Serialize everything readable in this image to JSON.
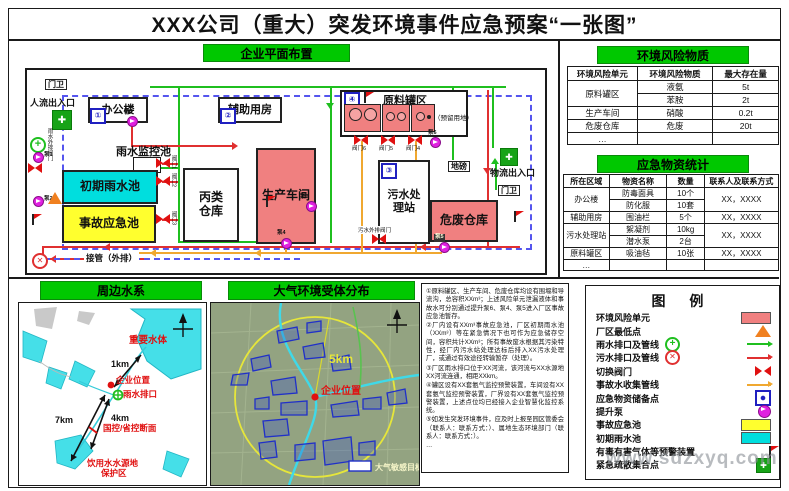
{
  "title": "XXX公司（重大）突发环境事件应急预案“一张图”",
  "watermark": "www.sdzxyq.com",
  "colors": {
    "header_green": "#00c800",
    "risk_unit_salmon": "#f08080",
    "initial_rain_cyan": "#00dede",
    "accident_pool_yellow": "#ffff2e",
    "rain_line_green": "#1fbf1f",
    "sewage_line_red": "#e03030",
    "accident_line_orange": "#f0a830",
    "pump_magenta": "#e020e0",
    "boundary_dash_blue": "#5555ee"
  },
  "plant": {
    "header": "企业平面布置",
    "gate1": "门卫",
    "gate2": "门卫",
    "people_entrance": "人流出入口",
    "logistics_entrance": "物流出入口",
    "office": "办公楼",
    "office_badge": "①",
    "aux_building": "辅助用房",
    "aux_badge": "②",
    "rain_monitor_pool": "雨水监控池",
    "initial_rain_pool": "初期雨水池",
    "accident_pool": "事故应急池",
    "class_c_warehouse": "丙类\n仓库",
    "workshop": "生产车间",
    "sewage_station": "污水处\n理站",
    "sewage_badge": "③",
    "hazwaste_warehouse": "危废仓库",
    "tank_area": "原料罐区",
    "tank_badge": "④",
    "reserved_land": "（预留用地）",
    "weighbridge": "地磅",
    "outfall_pipe": "接管（外排）",
    "sewage_out_valve": "污水外排阀门",
    "rain_out_valve": "雨水外排阀门",
    "valves": {
      "v1": "阀门1",
      "v2": "阀门2",
      "v3": "阀门3",
      "v4": "阀门4",
      "v5": "阀门5",
      "v6": "阀门6"
    },
    "pumps": {
      "p1": "泵1",
      "p2": "泵2",
      "p3": "泵3",
      "p4": "泵4",
      "p5": "泵5",
      "p6": "泵6",
      "p7": "泵7"
    }
  },
  "risk_table": {
    "header": "环境风险物质",
    "columns": [
      "环境风险单元",
      "环境风险物质",
      "最大存在量"
    ],
    "rows": [
      {
        "unit": "原料罐区",
        "substance": "液氨",
        "amount": "5t"
      },
      {
        "substance": "苯胺",
        "amount": "2t"
      },
      {
        "unit": "生产车间",
        "substance": "硝酸",
        "amount": "0.2t"
      },
      {
        "unit": "危废仓库",
        "substance": "危废",
        "amount": "20t"
      },
      {
        "unit": "…",
        "substance": "",
        "amount": ""
      }
    ]
  },
  "supplies_table": {
    "header": "应急物资统计",
    "columns": [
      "所在区域",
      "物资名称",
      "数量",
      "联系人及联系方式"
    ],
    "rows": [
      {
        "area": "办公楼",
        "name": "防毒面具",
        "qty": "10个",
        "contact": "XX，XXXX"
      },
      {
        "name": "防化服",
        "qty": "10套"
      },
      {
        "area": "辅助用房",
        "name": "围油栏",
        "qty": "5个",
        "contact": "XX，XXXX"
      },
      {
        "area": "污水处理站",
        "name": "絮凝剂",
        "qty": "10kg",
        "contact": "XX，XXXX"
      },
      {
        "name": "潜水泵",
        "qty": "2台"
      },
      {
        "area": "原料罐区",
        "name": "吸油毡",
        "qty": "10张",
        "contact": "XX，XXXX"
      },
      {
        "area": "…",
        "name": "",
        "qty": "",
        "contact": ""
      }
    ]
  },
  "legend": {
    "header": "图  例",
    "items": [
      {
        "label": "环境风险单元",
        "symbol": "risk-unit-swatch"
      },
      {
        "label": "厂区最低点",
        "symbol": "lowest-point-triangle"
      },
      {
        "label": "雨水排口及管线",
        "symbol": "rain-outlet-and-line"
      },
      {
        "label": "污水排口及管线",
        "symbol": "sewage-outlet-and-line"
      },
      {
        "label": "切换阀门",
        "symbol": "switch-valve"
      },
      {
        "label": "事故水收集管线",
        "symbol": "accident-water-line"
      },
      {
        "label": "应急物资储备点",
        "symbol": "supplies-point"
      },
      {
        "label": "提升泵",
        "symbol": "lift-pump"
      },
      {
        "label": "事故应急池",
        "symbol": "accident-pool-swatch"
      },
      {
        "label": "初期雨水池",
        "symbol": "initial-rain-pool-swatch"
      },
      {
        "label": "有毒有害气体等预警装置",
        "symbol": "gas-warning-flag"
      },
      {
        "label": "紧急疏散集合点",
        "symbol": "assembly-point"
      }
    ]
  },
  "notes": {
    "items": [
      "①原料罐区、生产车间、危废仓库均设有围堰和导流沟，总容积XXm³；上述风险单元泄漏液体和事故水可分别通过提升泵6、泵4、泵5进入厂区事故应急池暂存。",
      "②厂内设有XXm³事故应急池，厂区初期雨水池（XXm³）等在紧急情况下也可作为应急储存空间，容积共计XXm³；所有事故废水根据其污染特性，经厂内污水站处理达标后排入XX污水处理厂，或通过有效途径转输暂存（处理）。",
      "③厂区雨水排口位于XX河流，该河流与XX水源地XX河流连通，相距XXkm。",
      "④罐区设有XX套氨气监控预警装置，车间设有XX套氨气监控预警装置，厂界设有XX套氨气监控预警装置，上述点位均已经接入企业智慧化监控系统。",
      "⑤如发生突发环境事件，应及时上报至园区管委会（联系人：联系方式：）、属地生态环境部门（联系人：联系方式：）。",
      "…"
    ]
  },
  "water_map": {
    "header": "周边水系",
    "important_water": "重要水体",
    "company_location": "企业位置",
    "rain_outlet": "雨水排口",
    "control_section": "国控/省控断面",
    "drinking_water_1": "饮用水水源地",
    "drinking_water_2": "保护区",
    "d1": "1km",
    "d2": "4km",
    "d3": "7km"
  },
  "air_map": {
    "header": "大气环境受体分布",
    "radius_label": "5km",
    "company_location": "企业位置",
    "legend_label": "大气敏感目标"
  }
}
